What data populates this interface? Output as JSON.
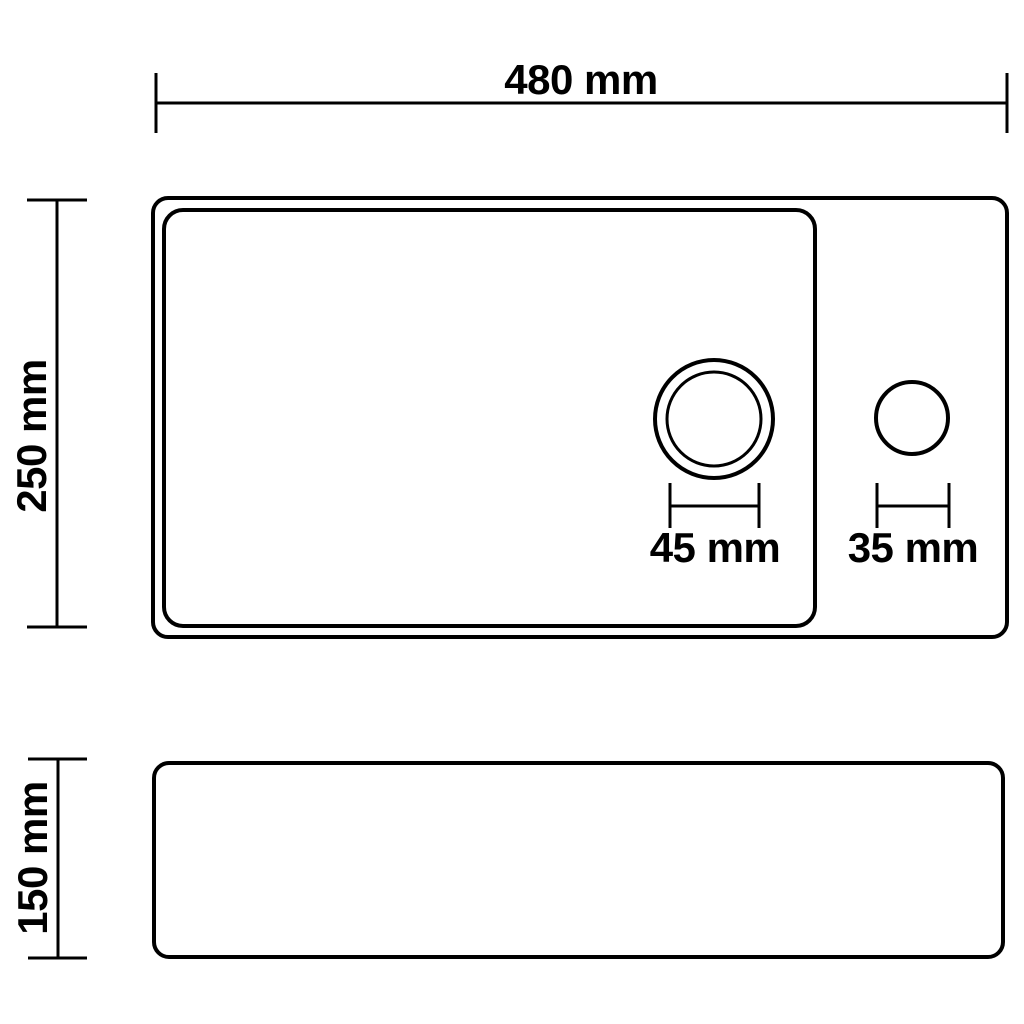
{
  "colors": {
    "background": "#ffffff",
    "line": "#000000",
    "text": "#000000"
  },
  "diagram": {
    "subject": "sink-dimension-drawing",
    "views": {
      "top_view": "sink top view with basin, drain hole and faucet hole",
      "side_view": "sink front elevation"
    }
  },
  "dimensions": {
    "overall_width": {
      "label": "480 mm"
    },
    "overall_depth": {
      "label": "250 mm"
    },
    "drain_diameter": {
      "label": "45 mm"
    },
    "faucet_hole_diameter": {
      "label": "35 mm"
    },
    "overall_height": {
      "label": "150 mm"
    }
  }
}
